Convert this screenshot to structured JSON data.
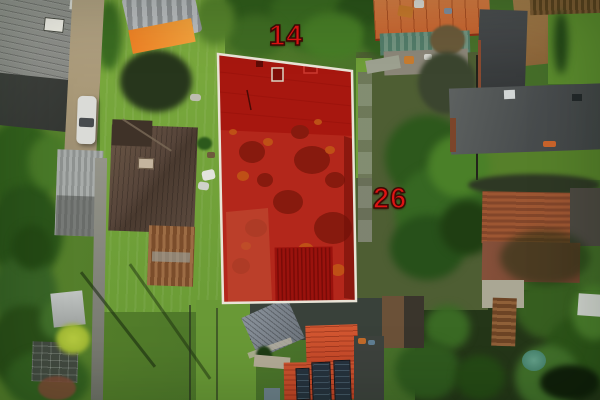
{
  "annotations": {
    "parcel_number": "14",
    "street_number": "26"
  },
  "colors": {
    "label_red": "#e01313",
    "label_outline": "#3c0b05",
    "parcel_fill": "#b3271b",
    "parcel_border": "#e9e4d7"
  }
}
